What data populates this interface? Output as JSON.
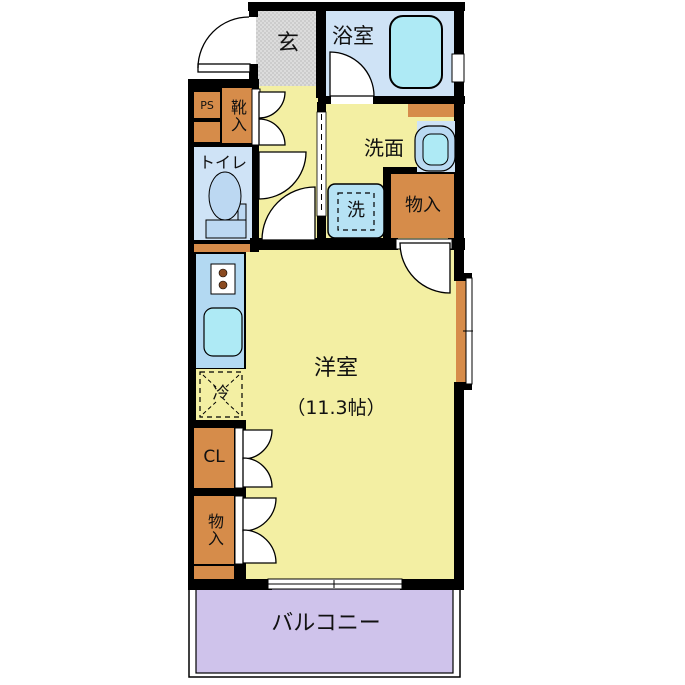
{
  "rooms": {
    "genkan": "玄",
    "bathroom": "浴室",
    "pipe_space": "PS",
    "shoe_cabinet": "靴入",
    "toilet": "トイレ",
    "washroom": "洗面",
    "washing_machine": "洗",
    "storage_upper": "物入",
    "main_room_name": "洋室",
    "main_room_size": "（11.3帖）",
    "refrigerator": "冷",
    "closet": "CL",
    "storage_lower": "物入",
    "balcony": "バルコニー"
  },
  "colors": {
    "wall": "#000000",
    "floor_yellow": "#f3efa3",
    "genkan_gray": "#dcdcdc",
    "water_blue": "#cfe3f6",
    "fixture_cyan": "#aeeaf5",
    "storage_orange": "#d68c4a",
    "kitchen_blue": "#b3d9f2",
    "toilet_fixture_blue": "#bcd8f2",
    "balcony_purple": "#cfc3eb"
  }
}
